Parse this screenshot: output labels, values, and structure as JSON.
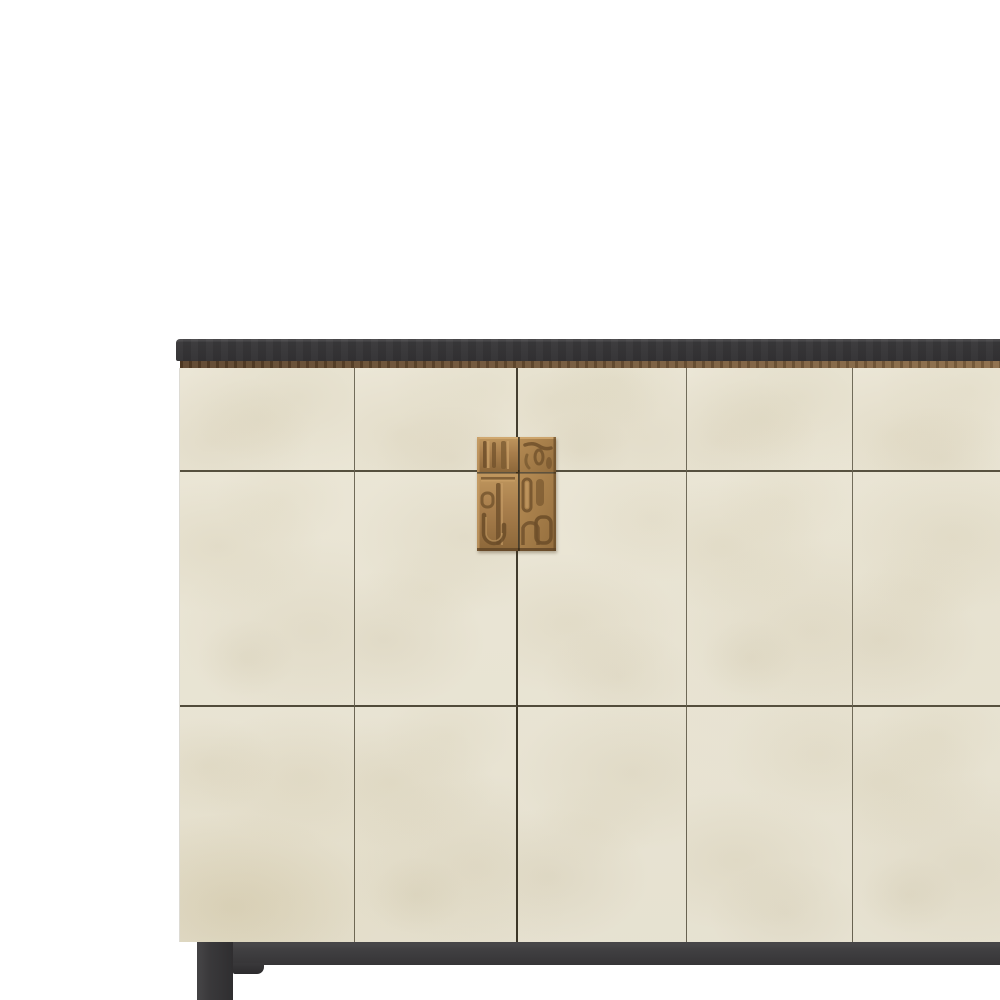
{
  "image": {
    "type": "product-render",
    "subject": "sideboard-cabinet",
    "background_color": "#ffffff"
  },
  "colors": {
    "background": "#ffffff",
    "top_slab": "#39383a",
    "top_slab_highlight": "#4b4a4c",
    "trim_dark": "#5a4128",
    "trim_light": "#8a6a45",
    "body_base": "#eae5d4",
    "body_mottle": "#d9d0b6",
    "body_stain": "#d3c8a6",
    "seam": "#6a6452",
    "seam_dark": "#3a3425",
    "seam_horizontal": "#4e4836",
    "handle_base": "#a87e4c",
    "handle_light": "#cfa770",
    "handle_dark": "#5c4124",
    "base_rail": "#414042",
    "leg": "#3a393b"
  },
  "furniture": {
    "parts": [
      "top-slab",
      "wood-trim-strip",
      "parchment-panel-front",
      "bronze-carved-handle",
      "base-rail",
      "front-left-leg",
      "leg-bracket"
    ],
    "panel_grid": {
      "columns": 5,
      "rows": 3
    },
    "handle": {
      "material": "bronze",
      "style": "abstract-relief",
      "split_by_door_seam": true
    },
    "crop": {
      "right_edge_cut_off": true,
      "bottom_leg_cut_off": true
    }
  }
}
